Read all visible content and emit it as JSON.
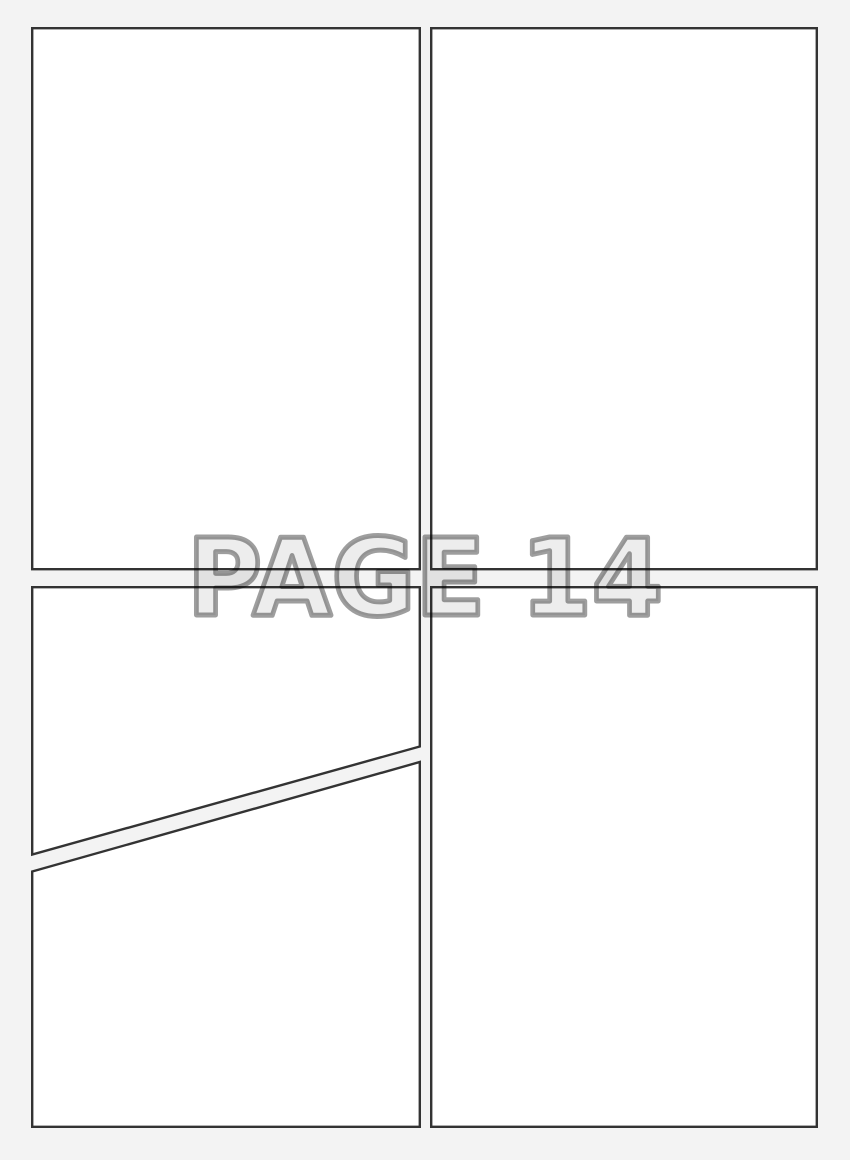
{
  "document": {
    "title": "Blank comic page layout template",
    "watermark": {
      "label": "PAGE 14"
    },
    "panels": [
      {
        "name": "top-left",
        "shape": "rectangle"
      },
      {
        "name": "top-right",
        "shape": "rectangle"
      },
      {
        "name": "bottom-left-upper",
        "shape": "quadrilateral-diagonal-bottom"
      },
      {
        "name": "bottom-left-lower",
        "shape": "quadrilateral-diagonal-top"
      },
      {
        "name": "bottom-right",
        "shape": "rectangle"
      }
    ],
    "colors": {
      "background": "#f3f3f3",
      "panel_fill": "#ffffff",
      "panel_border": "#333333",
      "watermark_fill": "#ededed",
      "watermark_outline": "#9a9a9a"
    }
  }
}
